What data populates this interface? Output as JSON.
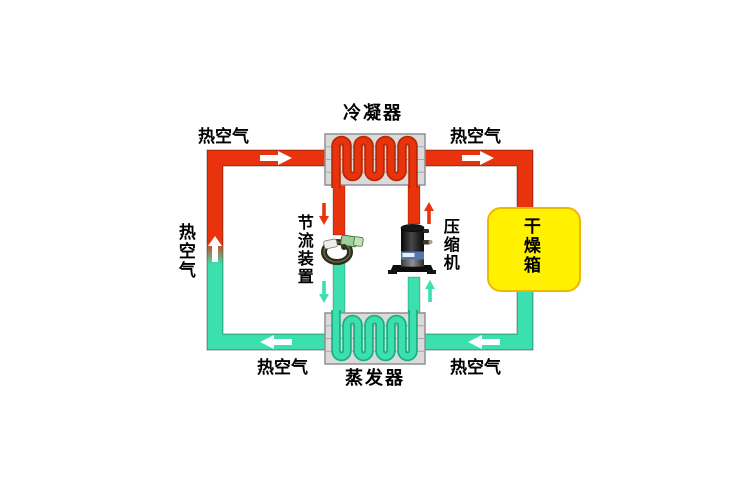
{
  "diagram": {
    "title": "heat-pump drying system schematic",
    "components": {
      "condenser": {
        "label": "冷凝器"
      },
      "evaporator": {
        "label": "蒸发器"
      },
      "throttle_device": {
        "label": "节流装置"
      },
      "compressor": {
        "label": "压缩机"
      },
      "drying_box": {
        "label": "干燥箱"
      }
    },
    "air_flow_labels": {
      "top_left": "热空气",
      "top_right": "热空气",
      "left_side": "热空气",
      "bottom_left": "热空气",
      "bottom_right": "热空气"
    },
    "flow_directions": {
      "top_duct": "right",
      "bottom_duct": "left",
      "left_duct": "up",
      "condenser_to_throttle": "down",
      "throttle_to_evaporator": "down",
      "evaporator_to_compressor": "up",
      "compressor_to_condenser": "up"
    },
    "colors": {
      "hot_pipe": "#e8330d",
      "hot_pipe_edge": "#b82806",
      "cold_pipe": "#3cdfae",
      "cold_pipe_edge": "#17b183",
      "coil_box_fill": "#dadada",
      "coil_box_border": "#8f8f8f",
      "drying_box_fill": "#fff100",
      "drying_box_border": "#edb800",
      "arrow_white": "#ffffff",
      "text": "#000000",
      "background": "#ffffff"
    }
  }
}
